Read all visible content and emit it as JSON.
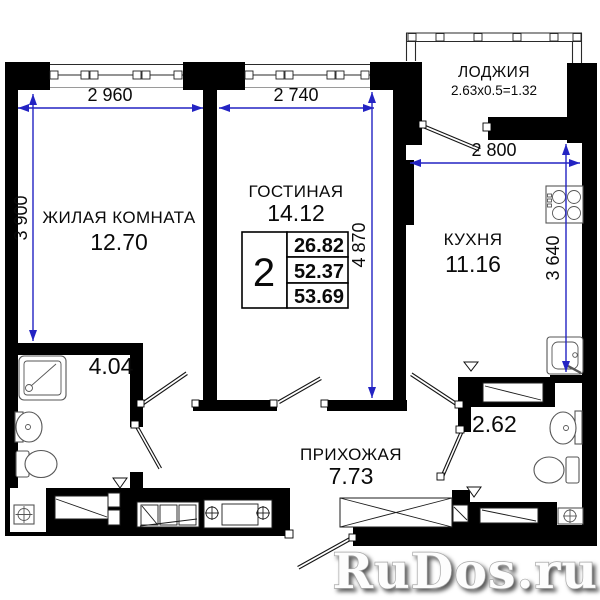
{
  "colors": {
    "wall": "#000000",
    "dimension": "#2323c3",
    "accent_green": "#a4c75e",
    "watermark_fill": "#fdfdfd"
  },
  "rooms": {
    "living1": {
      "name": "ЖИЛАЯ КОМНАТА",
      "area": "12.70"
    },
    "living2": {
      "name": "ГОСТИНАЯ",
      "area": "14.12"
    },
    "kitchen": {
      "name": "КУХНЯ",
      "area": "11.16"
    },
    "hall": {
      "name": "ПРИХОЖАЯ",
      "area": "7.73"
    },
    "loggia": {
      "name": "ЛОДЖИЯ",
      "formula": "2.63x0.5=1.32"
    },
    "bath1": {
      "area": "4.04"
    },
    "bath2": {
      "area": "2.62"
    }
  },
  "dimensions": {
    "living1_width": "2 960",
    "living2_width": "2 740",
    "kitchen_width": "2 800",
    "living1_height": "3 900",
    "living2_height": "4 870",
    "kitchen_height": "3 640"
  },
  "summary": {
    "rooms_count": "2",
    "values": [
      "26.82",
      "52.37",
      "53.69"
    ]
  },
  "watermark": {
    "text": "RuDos.ru"
  }
}
